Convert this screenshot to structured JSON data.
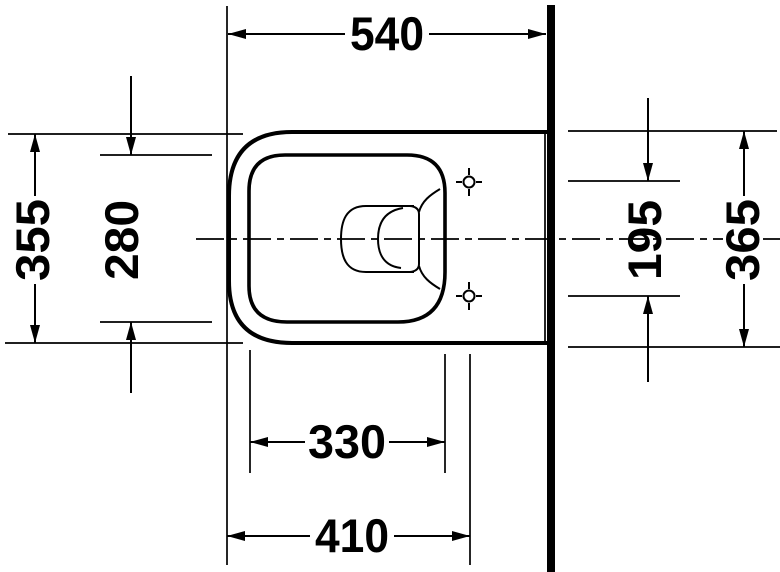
{
  "drawing": {
    "kind": "technical-dimension-drawing",
    "subject": "wall-hung-toilet-top-view",
    "colors": {
      "line": "#000000",
      "background": "#ffffff",
      "wall_fill": "#000000"
    },
    "dimensions": {
      "dim_top": "540",
      "dim_left_outer": "355",
      "dim_left_inner": "280",
      "dim_right_inner": "195",
      "dim_right_outer": "365",
      "dim_bottom_inner": "330",
      "dim_bottom_outer": "410"
    }
  }
}
